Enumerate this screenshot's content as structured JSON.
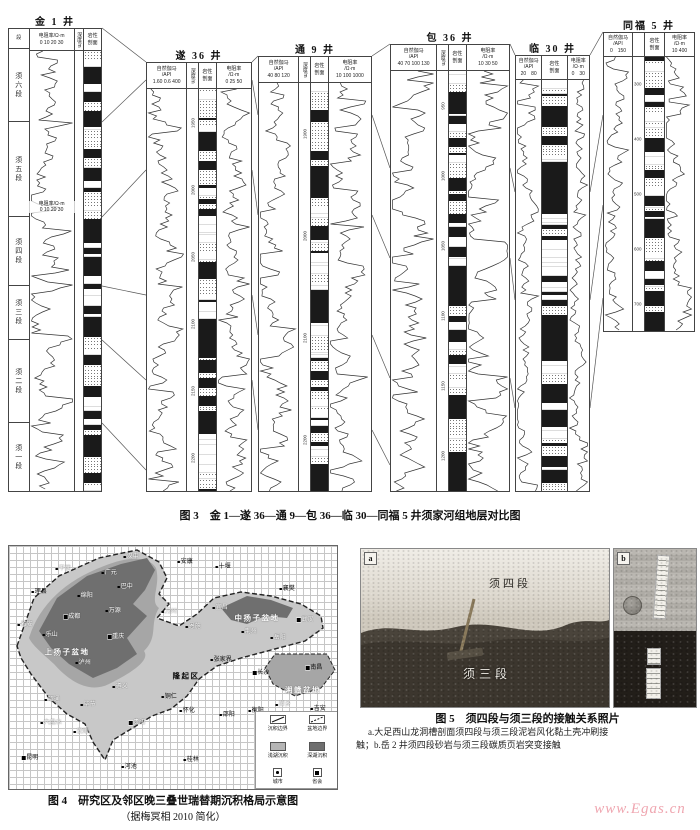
{
  "fig3": {
    "caption": "图 3　金 1—遂 36—通 9—包 36—临 30—同福 5 井须家河组地层对比图",
    "members": [
      "须六段",
      "须五段",
      "须四段",
      "须三段",
      "须二段",
      "须一段"
    ],
    "wells": [
      {
        "name": "金 1 井",
        "seg_header": "段",
        "res_title": "电阻率/Ω·m",
        "res_scale": "0 10 20 30",
        "depth_title": "深度/m",
        "lith_name": "岩性",
        "lith_name2": "剖面",
        "mid_title": "电阻率/Ω·m",
        "mid_scale": "0 10 20 30"
      },
      {
        "name": "遂 36 井",
        "gr_name": "自然伽马",
        "gr_unit": "/API",
        "gr_scale": "1.60 0.6 400",
        "depth_title": "深度/m",
        "depths": [
          "1950",
          "2000",
          "2050",
          "2100",
          "2150",
          "2200"
        ],
        "lith_name": "岩性",
        "lith_name2": "剖面",
        "res_name": "电阻率",
        "res_unit": "/Ω·m",
        "res_scale": "0 25 50"
      },
      {
        "name": "通 9 井",
        "gr_name": "自然伽马",
        "gr_unit": "/API",
        "gr_scale": "40 80 120",
        "depth_title": "深度/m",
        "depths": [
          "1900",
          "2000",
          "2100",
          "2200"
        ],
        "lith_name": "岩性",
        "lith_name2": "剖面",
        "res_name": "电阻率",
        "res_unit": "/Ω·m",
        "res_scale": "10 100 1000"
      },
      {
        "name": "包 36 井",
        "gr_name": "自然伽马",
        "gr_unit": "/API",
        "gr_scale": "40 70 100 130",
        "depth_title": "深度/m",
        "depths": [
          "950",
          "1000",
          "1050",
          "1100",
          "1150",
          "1200"
        ],
        "lith_name": "岩性",
        "lith_name2": "剖面",
        "res_name": "电阻率",
        "res_unit": "/Ω·m",
        "res_scale": "10 30 50"
      },
      {
        "name": "临 30 井",
        "gr_name": "自然伽马",
        "gr_unit": "/API",
        "gr_scale": "20　80",
        "lith_name": "岩性",
        "lith_name2": "剖面",
        "res_name": "电阻率",
        "res_unit": "/Ω·m",
        "res_scale": "0　30"
      },
      {
        "name": "同福 5 井",
        "gr_name": "自然伽马",
        "gr_unit": "/API",
        "gr_scale": "0　150",
        "depths": [
          "300",
          "400",
          "500",
          "600",
          "700"
        ],
        "lith_name": "岩性",
        "lith_name2": "剖面",
        "res_name": "电阻率",
        "res_unit": "/Ω·m",
        "res_scale": "10 400"
      }
    ]
  },
  "fig4": {
    "caption": "图 4　研究区及邻区晚三叠世瑞替期沉积格局示意图",
    "caption_sub": "（据梅冥相 2010 简化）",
    "legend": {
      "b1": "沉积边界",
      "b2": "盆地边界",
      "s1": "浅湖沉积",
      "s2": "深湖沉积",
      "c1": "城市",
      "c2": "省会"
    },
    "map": {
      "labels": [
        {
          "t": "汉中",
          "x": 122,
          "y": 11,
          "c": "w",
          "m": "d"
        },
        {
          "t": "平武",
          "x": 54,
          "y": 23,
          "c": "w",
          "m": "d"
        },
        {
          "t": "广元",
          "x": 100,
          "y": 27,
          "c": "w",
          "m": "d"
        },
        {
          "t": "巴中",
          "x": 116,
          "y": 41,
          "c": "w",
          "m": "d"
        },
        {
          "t": "安康",
          "x": 176,
          "y": 16,
          "c": "b",
          "m": "d"
        },
        {
          "t": "十堰",
          "x": 214,
          "y": 21,
          "c": "b",
          "m": "d"
        },
        {
          "t": "襄樊",
          "x": 278,
          "y": 43,
          "c": "b",
          "m": "d"
        },
        {
          "t": "理县",
          "x": 30,
          "y": 46,
          "c": "b",
          "m": "d"
        },
        {
          "t": "绵阳",
          "x": 76,
          "y": 50,
          "c": "w",
          "m": "d"
        },
        {
          "t": "万源",
          "x": 104,
          "y": 65,
          "c": "w",
          "m": "d"
        },
        {
          "t": "万州",
          "x": 160,
          "y": 66,
          "c": "w",
          "m": "d"
        },
        {
          "t": "成都",
          "x": 63,
          "y": 71,
          "c": "w",
          "m": "s"
        },
        {
          "t": "雅安",
          "x": 16,
          "y": 79,
          "c": "w",
          "m": "d"
        },
        {
          "t": "乐山",
          "x": 41,
          "y": 89,
          "c": "w",
          "m": "d"
        },
        {
          "t": "重庆",
          "x": 107,
          "y": 91,
          "c": "w",
          "m": "s"
        },
        {
          "t": "上扬子盆地",
          "x": 58,
          "y": 106,
          "c": "w",
          "b": 1
        },
        {
          "t": "泸州",
          "x": 74,
          "y": 117,
          "c": "w",
          "m": "d"
        },
        {
          "t": "宜昌",
          "x": 211,
          "y": 62,
          "c": "w",
          "m": "d"
        },
        {
          "t": "中扬子盆地",
          "x": 248,
          "y": 72,
          "c": "w",
          "b": 1
        },
        {
          "t": "武汉",
          "x": 296,
          "y": 74,
          "c": "w",
          "m": "s"
        },
        {
          "t": "荆州",
          "x": 240,
          "y": 86,
          "c": "w",
          "m": "d"
        },
        {
          "t": "岳阳",
          "x": 269,
          "y": 92,
          "c": "w",
          "m": "d"
        },
        {
          "t": "恩施",
          "x": 184,
          "y": 81,
          "c": "w",
          "m": "d"
        },
        {
          "t": "张家界",
          "x": 212,
          "y": 114,
          "c": "b",
          "m": "d"
        },
        {
          "t": "隆起区",
          "x": 177,
          "y": 130,
          "c": "b",
          "b": 1
        },
        {
          "t": "长沙",
          "x": 252,
          "y": 127,
          "c": "b",
          "m": "s"
        },
        {
          "t": "南昌",
          "x": 305,
          "y": 122,
          "c": "b",
          "m": "s"
        },
        {
          "t": "湘赣盆地",
          "x": 294,
          "y": 144,
          "c": "w",
          "b": 1
        },
        {
          "t": "遵义",
          "x": 111,
          "y": 141,
          "c": "w",
          "m": "d"
        },
        {
          "t": "铜仁",
          "x": 160,
          "y": 151,
          "c": "b",
          "m": "d"
        },
        {
          "t": "怀化",
          "x": 178,
          "y": 165,
          "c": "b",
          "m": "d"
        },
        {
          "t": "昭通",
          "x": 43,
          "y": 154,
          "c": "w",
          "m": "d"
        },
        {
          "t": "毕节",
          "x": 79,
          "y": 159,
          "c": "w",
          "m": "d"
        },
        {
          "t": "六盘水",
          "x": 42,
          "y": 177,
          "c": "w",
          "m": "d"
        },
        {
          "t": "贵阳",
          "x": 128,
          "y": 177,
          "c": "w",
          "m": "s"
        },
        {
          "t": "安顺",
          "x": 72,
          "y": 186,
          "c": "w",
          "m": "d"
        },
        {
          "t": "邵阳",
          "x": 218,
          "y": 169,
          "c": "b",
          "m": "d"
        },
        {
          "t": "衡阳",
          "x": 247,
          "y": 165,
          "c": "b",
          "m": "d"
        },
        {
          "t": "萍乡",
          "x": 274,
          "y": 159,
          "c": "w",
          "m": "d"
        },
        {
          "t": "吉安",
          "x": 309,
          "y": 163,
          "c": "b",
          "m": "d"
        },
        {
          "t": "昆明",
          "x": 21,
          "y": 212,
          "c": "b",
          "m": "s"
        },
        {
          "t": "河池",
          "x": 120,
          "y": 221,
          "c": "b",
          "m": "d"
        },
        {
          "t": "桂林",
          "x": 182,
          "y": 214,
          "c": "b",
          "m": "d"
        }
      ]
    }
  },
  "fig5": {
    "caption": "图 5　须四段与须三段的接触关系照片",
    "note1": "a.大足西山龙洞槽剖面须四段与须三段泥岩风化黏土壳冲刷接",
    "note2": "触；b.岳 2 井须四段砂岩与须三段碳质页岩突变接触",
    "tag_a": "a",
    "tag_b": "b",
    "label_upper": "须四段",
    "label_lower": "须三段"
  },
  "watermark": "www.Egas.cn"
}
